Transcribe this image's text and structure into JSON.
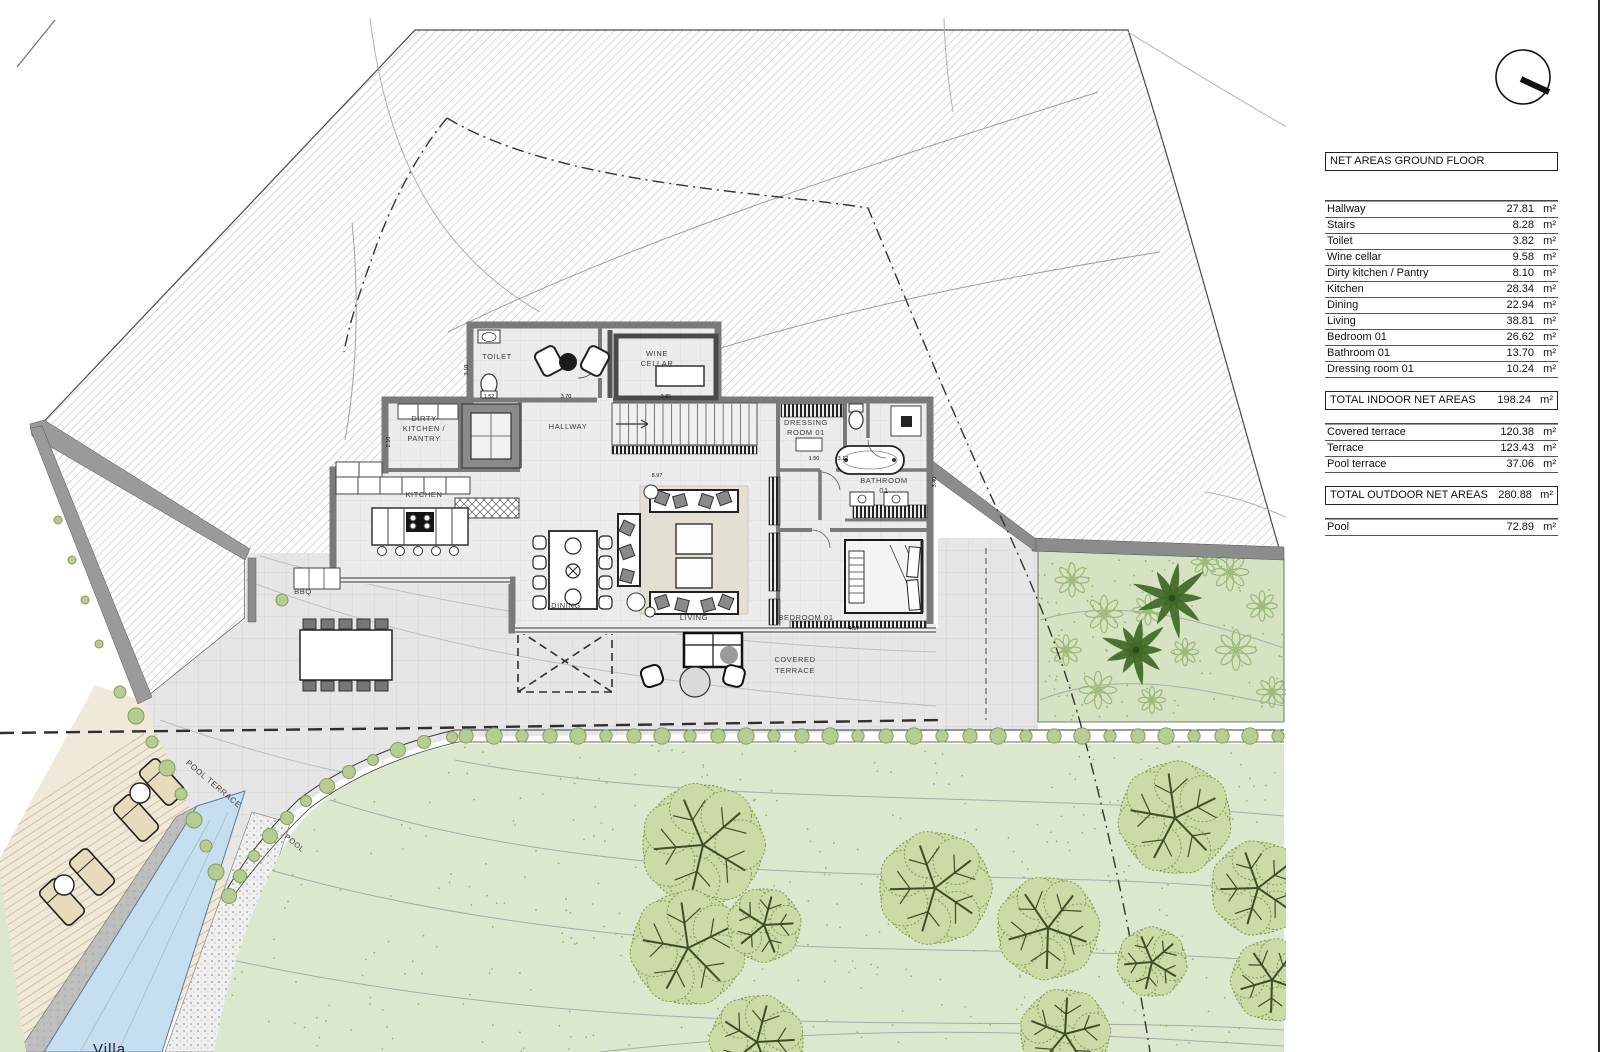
{
  "table": {
    "title": "NET AREAS GROUND FLOOR",
    "unit": "m²",
    "indoor_rows": [
      {
        "name": "Hallway",
        "value": "27.81"
      },
      {
        "name": "Stairs",
        "value": "8.28"
      },
      {
        "name": "Toilet",
        "value": "3.82"
      },
      {
        "name": "Wine cellar",
        "value": "9.58"
      },
      {
        "name": "Dirty kitchen / Pantry",
        "value": "8.10"
      },
      {
        "name": "Kitchen",
        "value": "28.34"
      },
      {
        "name": "Dining",
        "value": "22.94"
      },
      {
        "name": "Living",
        "value": "38.81"
      },
      {
        "name": "Bedroom 01",
        "value": "26.62"
      },
      {
        "name": "Bathroom 01",
        "value": "13.70"
      },
      {
        "name": "Dressing room 01",
        "value": "10.24"
      }
    ],
    "total_indoor": {
      "label": "TOTAL INDOOR NET AREAS",
      "value": "198.24"
    },
    "outdoor_rows": [
      {
        "name": "Covered terrace",
        "value": "120.38"
      },
      {
        "name": "Terrace",
        "value": "123.43"
      },
      {
        "name": "Pool terrace",
        "value": "37.06"
      }
    ],
    "total_outdoor": {
      "label": "TOTAL OUTDOOR NET AREAS",
      "value": "280.88"
    },
    "extra_rows": [
      {
        "name": "Pool",
        "value": "72.89"
      }
    ]
  },
  "plan": {
    "room_labels": [
      {
        "text": "TOILET",
        "x": 497,
        "y": 359
      },
      {
        "text": "WINE",
        "x": 657,
        "y": 356
      },
      {
        "text": "CELLAR",
        "x": 657,
        "y": 366
      },
      {
        "text": "HALLWAY",
        "x": 568,
        "y": 429
      },
      {
        "text": "DIRTY",
        "x": 424,
        "y": 421
      },
      {
        "text": "KITCHEN /",
        "x": 424,
        "y": 431
      },
      {
        "text": "PANTRY",
        "x": 424,
        "y": 441
      },
      {
        "text": "KITCHEN",
        "x": 424,
        "y": 497
      },
      {
        "text": "DINING",
        "x": 566,
        "y": 608
      },
      {
        "text": "LIVING",
        "x": 694,
        "y": 620
      },
      {
        "text": "DRESSING",
        "x": 806,
        "y": 425
      },
      {
        "text": "ROOM 01",
        "x": 806,
        "y": 435
      },
      {
        "text": "BATHROOM",
        "x": 884,
        "y": 483
      },
      {
        "text": "01",
        "x": 884,
        "y": 493
      },
      {
        "text": "BEDROOM 01",
        "x": 806,
        "y": 620
      },
      {
        "text": "COVERED",
        "x": 795,
        "y": 662
      },
      {
        "text": "TERRACE",
        "x": 795,
        "y": 673
      },
      {
        "text": "BBQ",
        "x": 303,
        "y": 594
      },
      {
        "text": "POOL TERRACE",
        "x": 212,
        "y": 786,
        "rot": 40
      },
      {
        "text": "POOL",
        "x": 293,
        "y": 845,
        "rot": 40
      }
    ],
    "dim_labels": [
      {
        "text": "1.52",
        "x": 489,
        "y": 398
      },
      {
        "text": "3.70",
        "x": 566,
        "y": 398
      },
      {
        "text": "3.85",
        "x": 666,
        "y": 398
      },
      {
        "text": "3.10",
        "x": 468,
        "y": 370,
        "rot": -90
      },
      {
        "text": "2.10",
        "x": 390,
        "y": 442,
        "rot": -90
      },
      {
        "text": "1.50",
        "x": 814,
        "y": 460
      },
      {
        "text": "3.12",
        "x": 843,
        "y": 460
      },
      {
        "text": "8.97",
        "x": 657,
        "y": 477
      },
      {
        "text": "4.17",
        "x": 854,
        "y": 630
      },
      {
        "text": "3.40",
        "x": 936,
        "y": 482,
        "rot": -90
      }
    ]
  },
  "footer": {
    "partial_text": "Villa"
  },
  "colors": {
    "lawn": "#dce8cd",
    "garden": "#d6e3c3",
    "pool": "#c6dff0",
    "terrace": "#e6e6e6",
    "house_floor": "#ececec",
    "wall": "#7a7a7a",
    "hatch": "#ababab",
    "hedge": "#b7cc92",
    "hedge_edge": "#7fa05a",
    "tree_canopy": "#ccdaa6",
    "tree_edge": "#7e9a53",
    "tree_branch": "#3f4e26",
    "palm": "#3f6827",
    "deck": "#f0e8d8",
    "plank": "#c8b797",
    "lounger": "#e7dbbc",
    "contour": "#b0b0b0"
  }
}
